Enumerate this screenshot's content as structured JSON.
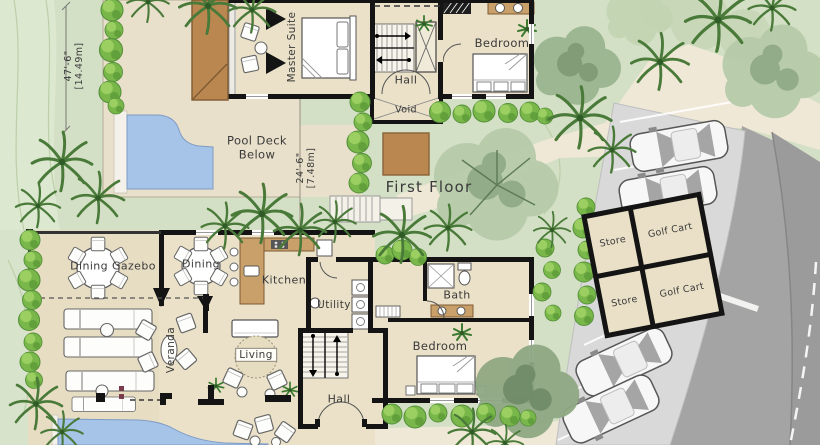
{
  "title": "Villa site / floor plan",
  "labels": {
    "master_suite": "Master Suite",
    "hall_upper": "Hall",
    "void": "Void",
    "bedroom_upper": "Bedroom",
    "pool_deck_1": "Pool Deck",
    "pool_deck_2": "Below",
    "first_floor": "First Floor",
    "dining_gazebo": "Dining Gazebo",
    "dining": "Dining",
    "kitchen": "Kitchen",
    "utility": "Utility",
    "bath": "Bath",
    "bedroom_lower": "Bedroom",
    "veranda": "Veranda",
    "living": "Living",
    "hall_lower": "Hall",
    "store_upper": "Store",
    "golf_cart_upper": "Golf Cart",
    "store_lower": "Store",
    "golf_cart_lower": "Golf Cart"
  },
  "dimensions": {
    "site_height_ft": "47'-6\"",
    "site_height_m": "[14.49m]",
    "deck_width_ft": "24'-6\"",
    "deck_width_m": "[7.48m]"
  },
  "colors": {
    "lawn": "#d4e0c6",
    "deck": "#e9e0cb",
    "interior_floor": "#eae1c8",
    "path": "#efe8d6",
    "road": "#a4a4a4",
    "parking": "#d9d9d9",
    "wall": "#141414",
    "roof_brown": "#b9874f",
    "pool_blue": "#a6c3e8",
    "counter_brown": "#c9a06a",
    "bush_green": "#79b74a",
    "palm_green": "#4a7a39",
    "canopy_green": "#b7cbaa",
    "text": "#3a3a3a"
  }
}
